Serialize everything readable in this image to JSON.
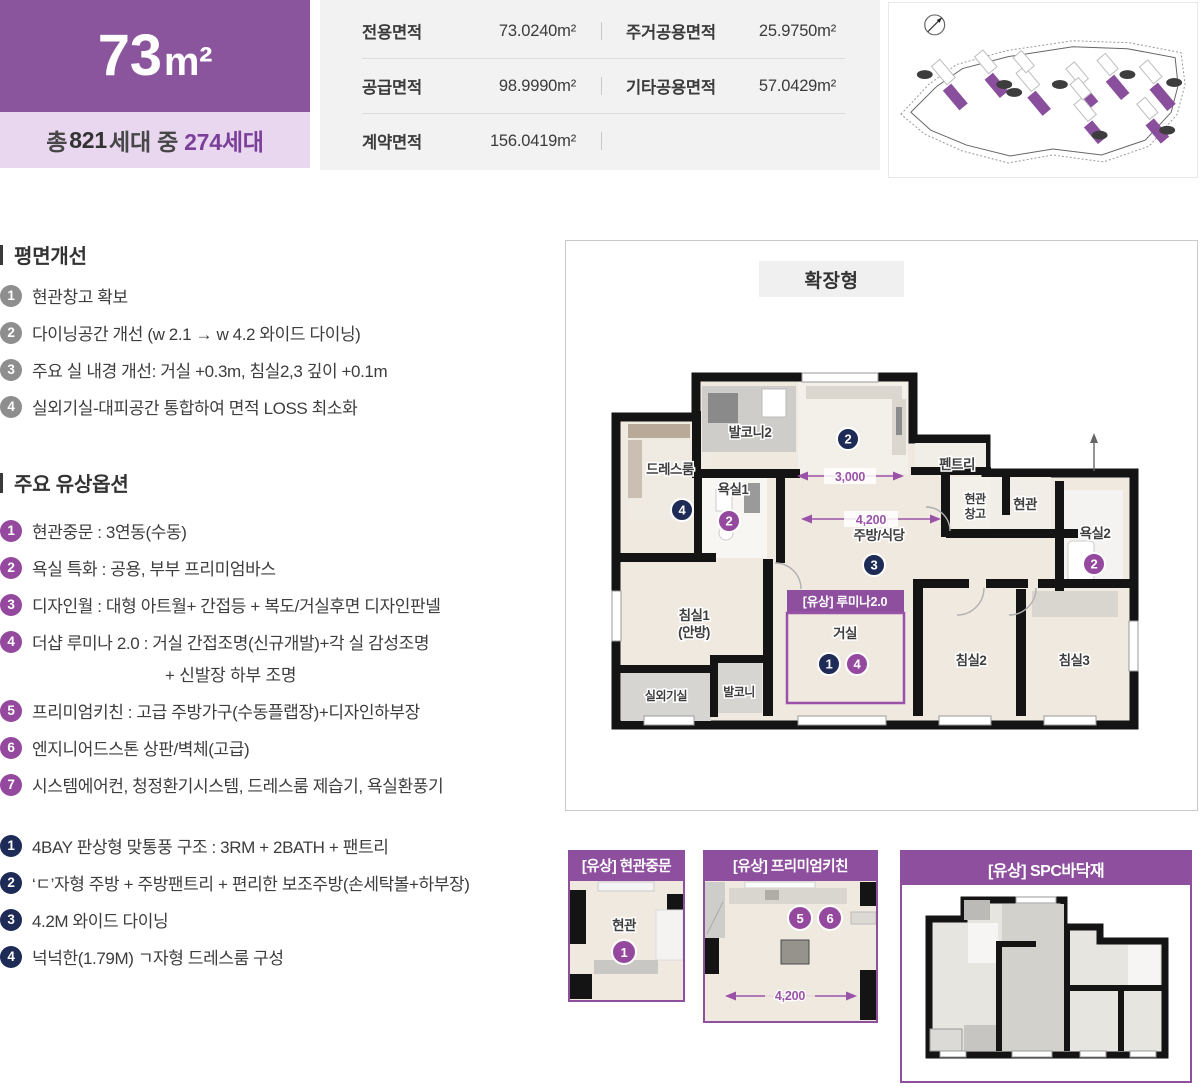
{
  "colors": {
    "primary_purple": "#8a559d",
    "light_purple": "#e9d7f0",
    "accent_purple": "#7b3f9a",
    "option_purple": "#94499e",
    "navy": "#1e2b56",
    "gray_circle": "#8e8e8e",
    "card_purple": "#8e4f9f"
  },
  "header": {
    "unit_size_num": "73",
    "unit_size_unit": "m²",
    "total_prefix": "총",
    "total_count": "821",
    "total_mid": "세대 중",
    "unit_count": "274세대"
  },
  "area_table": {
    "rows": [
      [
        {
          "label": "전용면적",
          "value": "73.0240m²"
        },
        {
          "label": "주거공용면적",
          "value": "25.9750m²"
        }
      ],
      [
        {
          "label": "공급면적",
          "value": "98.9990m²"
        },
        {
          "label": "기타공용면적",
          "value": "57.0429m²"
        }
      ],
      [
        {
          "label": "계약면적",
          "value": "156.0419m²"
        },
        {
          "label": "",
          "value": ""
        }
      ]
    ]
  },
  "plan_improvements": {
    "title": "평면개선",
    "items": [
      {
        "num": "1",
        "text": "현관창고 확보"
      },
      {
        "num": "2",
        "text": "다이닝공간 개선 (w 2.1 → w 4.2 와이드 다이닝)"
      },
      {
        "num": "3",
        "text": "주요 실 내경 개선: 거실 +0.3m, 침실2,3 깊이 +0.1m"
      },
      {
        "num": "4",
        "text": "실외기실-대피공간 통합하여 면적 LOSS 최소화"
      }
    ]
  },
  "paid_options": {
    "title": "주요 유상옵션",
    "items": [
      {
        "num": "1",
        "text": "현관중문 : 3연동(수동)"
      },
      {
        "num": "2",
        "text": "욕실 특화 : 공용, 부부 프리미엄바스"
      },
      {
        "num": "3",
        "text": "디자인월 : 대형 아트월+ 간접등 + 복도/거실후면 디자인판넬"
      },
      {
        "num": "4",
        "text": "더샵 루미나 2.0 : 거실 간접조명(신규개발)+각 실 감성조명",
        "text2": "+ 신발장 하부 조명"
      },
      {
        "num": "5",
        "text": "프리미엄키친 : 고급 주방가구(수동플랩장)+디자인하부장"
      },
      {
        "num": "6",
        "text": "엔지니어드스톤 상판/벽체(고급)"
      },
      {
        "num": "7",
        "text": "시스템에어컨, 청정환기시스템, 드레스룸 제습기, 욕실환풍기"
      }
    ]
  },
  "structure_features": {
    "items": [
      {
        "num": "1",
        "text": "4BAY 판상형  맞통풍 구조 : 3RM  + 2BATH + 팬트리"
      },
      {
        "num": "2",
        "text": "‘ㄷ’자형 주방 + 주방팬트리 + 편리한 보조주방(손세탁볼+하부장)"
      },
      {
        "num": "3",
        "text": "4.2M 와이드 다이닝"
      },
      {
        "num": "4",
        "text": "넉넉한(1.79M) ㄱ자형 드레스룸 구성"
      }
    ]
  },
  "floorplan": {
    "variant_label": "확장형",
    "lumina_label": "[유상] 루미나2.0",
    "rooms": {
      "balcony2": "발코니2",
      "dressroom": "드레스룸",
      "bath1": "욕실1",
      "bed1a": "침실1",
      "bed1b": "(안방)",
      "outdoor_unit": "실외기실",
      "balcony": "발코니",
      "living": "거실",
      "kitchen_dining": "주방/식당",
      "pantry": "펜트리",
      "entry_storage_a": "현관",
      "entry_storage_b": "창고",
      "entry": "현관",
      "bath2": "욕실2",
      "bed2": "침실2",
      "bed3": "침실3"
    },
    "dims": {
      "d3000": "3,000",
      "d4200": "4,200"
    },
    "markers": {
      "living_navy": "1",
      "kitchen_navy": "2",
      "dining_navy": "3",
      "dress_navy": "4",
      "bath1_purple": "2",
      "bath2_purple": "2",
      "living_purple": "4"
    }
  },
  "option_cards": [
    {
      "title": "[유상] 현관중문",
      "room": "현관",
      "num": "1"
    },
    {
      "title": "[유상] 프리미엄키친",
      "num5": "5",
      "num6": "6",
      "dim": "4,200"
    },
    {
      "title": "[유상] SPC바닥재"
    }
  ]
}
